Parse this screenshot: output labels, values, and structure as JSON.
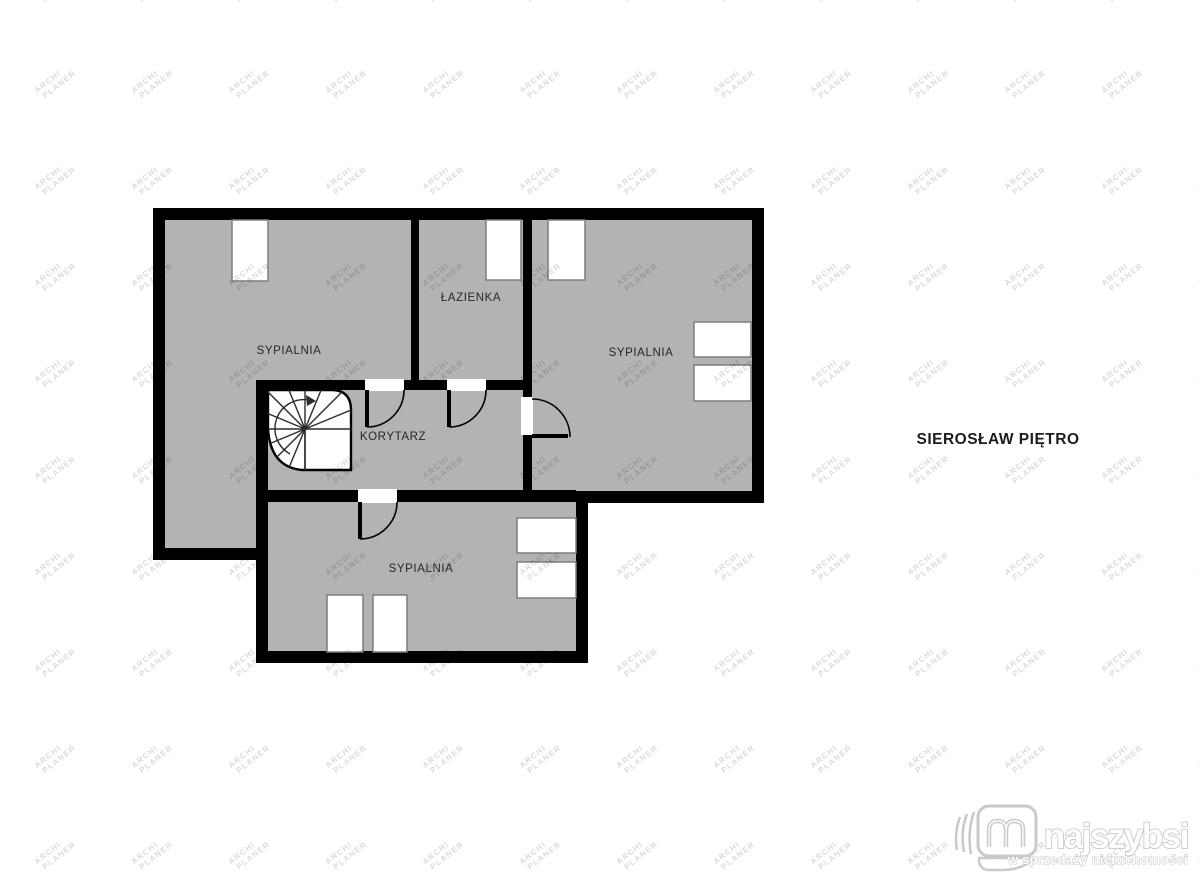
{
  "title": "SIEROSŁAW PIĘTRO",
  "watermark": {
    "line1": "ARCHI",
    "line2": "PLANER"
  },
  "rooms": {
    "bedroom_left": {
      "label": "SYPIALNIA"
    },
    "bathroom": {
      "label": "ŁAZIENKA"
    },
    "bedroom_right": {
      "label": "SYPIALNIA"
    },
    "corridor": {
      "label": "KORYTARZ"
    },
    "bedroom_bottom": {
      "label": "SYPIALNIA"
    }
  },
  "logo": {
    "brand": "najszybsi",
    "tagline": "w sprzedaży nieruchomości"
  },
  "colors": {
    "floor_fill": "#b3b3b3",
    "wall": "#000000",
    "furniture_fill": "#ffffff",
    "furniture_border": "#7d7d7d",
    "label_color": "#262626",
    "watermark_color": "rgba(0,0,0,0.15)",
    "logo_color": "#c3c3c3"
  }
}
